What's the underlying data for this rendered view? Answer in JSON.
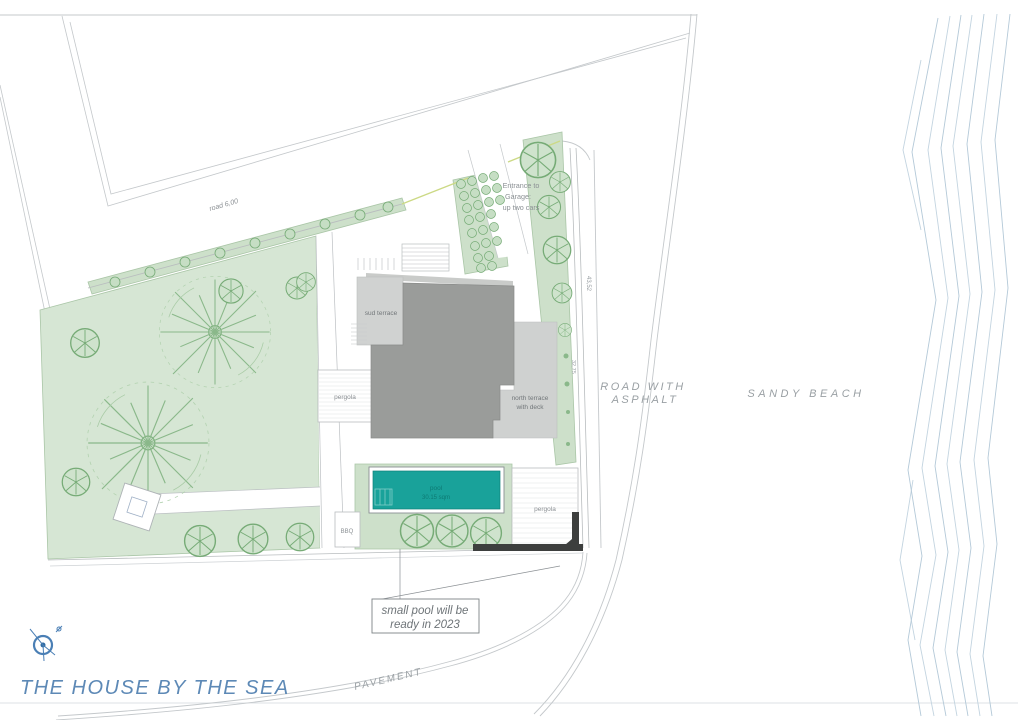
{
  "title": "THE HOUSE BY THE SEA",
  "labels": {
    "road_top": "road 6,00",
    "entrance": [
      "Entrance to",
      "Garage:",
      "up two cars"
    ],
    "sud_terrace": "sud terrace",
    "north_terrace": [
      "north terrace",
      "with deck"
    ],
    "pergola_west": "pergola",
    "pergola_east": "pergola",
    "pool": [
      "pool",
      "30.15 sqm"
    ],
    "bbq": "BBQ",
    "road_asphalt": [
      "ROAD WITH",
      "ASPHALT"
    ],
    "sandy_beach": "SANDY BEACH",
    "pavement": "PAVEMENT",
    "dimensions": [
      "43,52",
      "32,75"
    ]
  },
  "note": [
    "small pool will be",
    "ready in 2023"
  ],
  "colors": {
    "garden_green": "#d6e6d4",
    "patch_green": "#cde0ca",
    "tree_stroke": "#76ab76",
    "house_gray": "#9a9c9a",
    "terrace_gray": "#d0d2d1",
    "pool_teal": "#19a29a",
    "wall_dark": "#3d3f3e",
    "boundary_yellow": "#ccd985",
    "line_gray": "#bcc0c3",
    "label_gray": "#8b9094",
    "accent_blue": "#5d89b6",
    "sea_line_blue": "#b4c9d8"
  }
}
